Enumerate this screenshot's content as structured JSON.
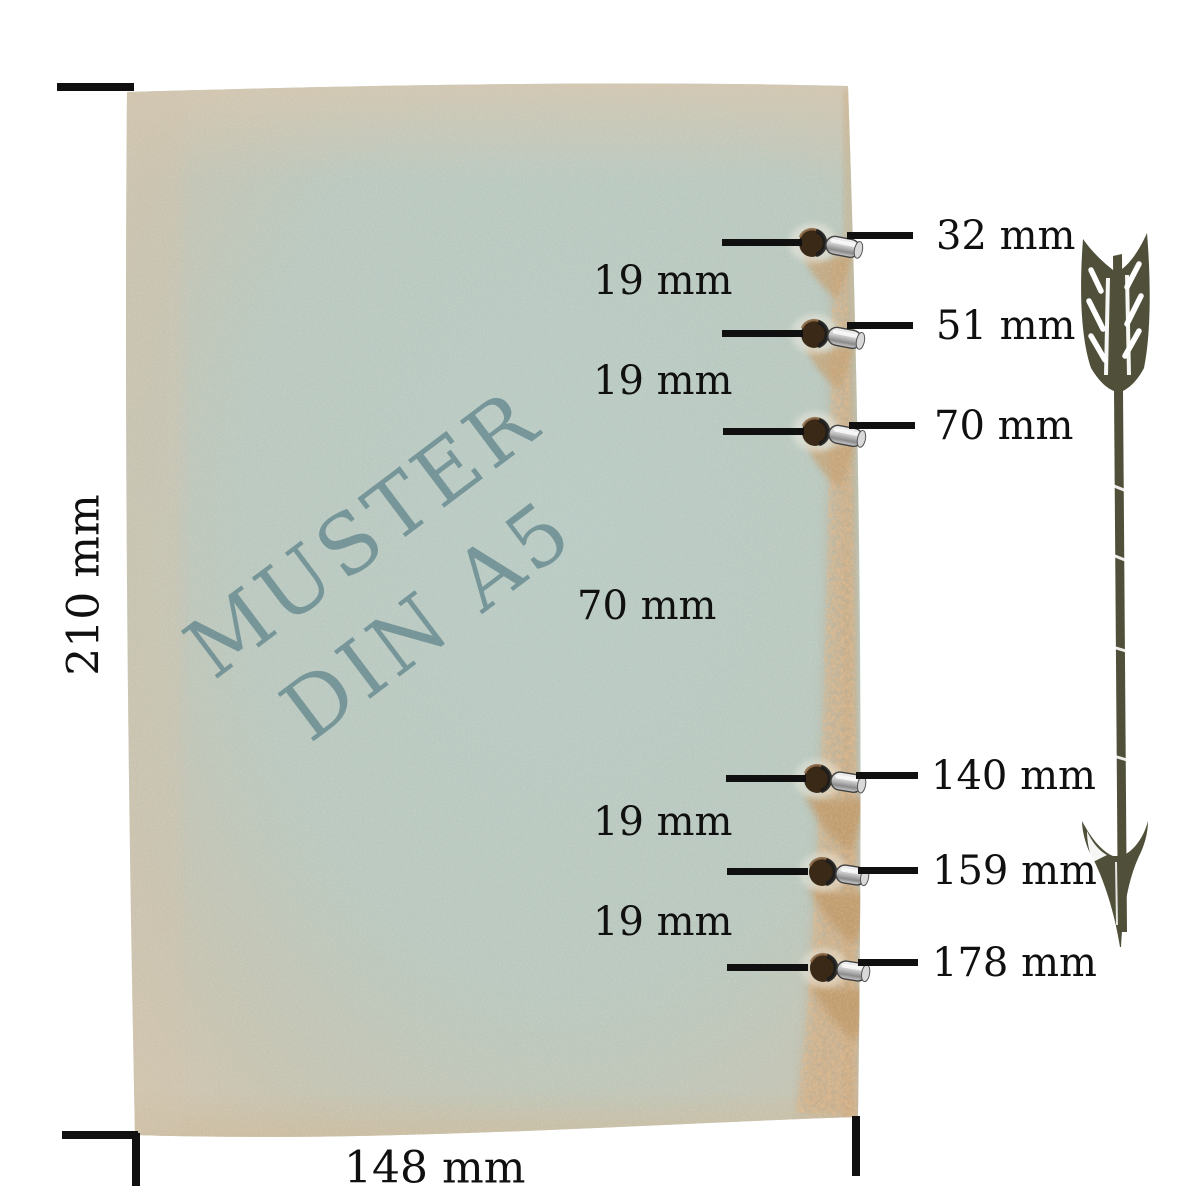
{
  "title": "Muster DIN A5 Lochabstände",
  "paper": {
    "watermark_line1": "MUSTER",
    "watermark_line2": "DIN A5"
  },
  "measurements": {
    "sheet_height": "210 mm",
    "sheet_width": "148 mm",
    "hole_positions": [
      "32 mm",
      "51 mm",
      "70 mm",
      "140 mm",
      "159 mm",
      "178 mm"
    ],
    "hole_gaps": [
      "19 mm",
      "19 mm",
      "70 mm",
      "19 mm",
      "19 mm"
    ]
  },
  "icons": {
    "arrow": "feathered-arrow-down-icon"
  },
  "colors": {
    "background": "#ffffff",
    "dimension": "#101010",
    "watermark": "#6b8d92",
    "paper_center": "#b7cbc5",
    "paper_edge": "#d2c6b1",
    "rust": "#c08d5f",
    "hole": "#3a2917",
    "metal": "#c8c8c8",
    "arrow": "#50503a"
  }
}
